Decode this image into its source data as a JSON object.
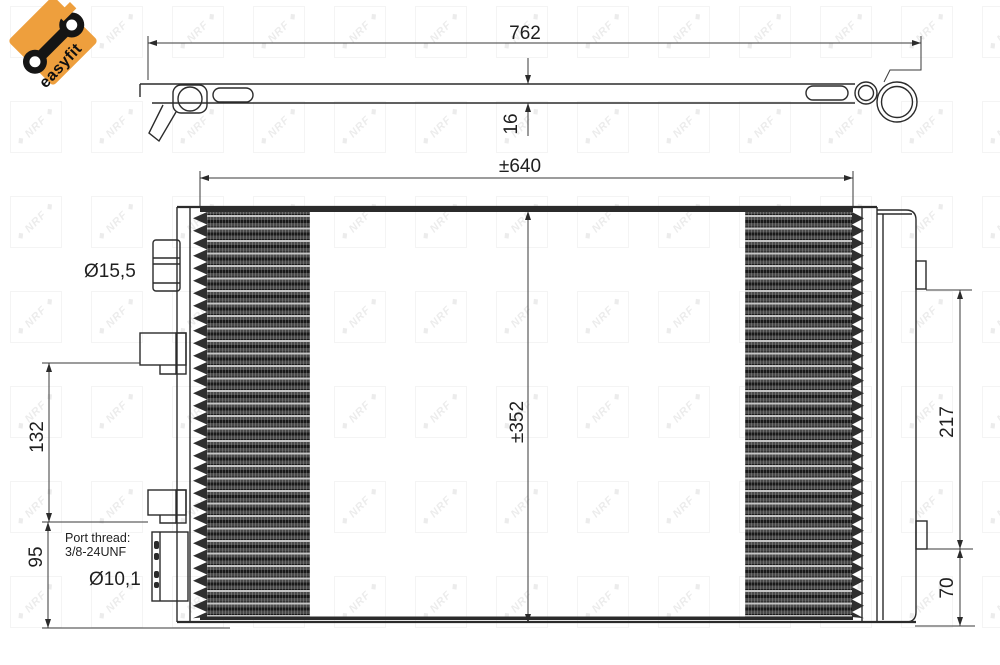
{
  "logo": {
    "brand": "easyfit",
    "bg_color": "#EE9F3D"
  },
  "watermark": {
    "text": "NRF",
    "diamond": "◆"
  },
  "dimensions": {
    "overall_length": "762",
    "thickness": "16",
    "core_width": "±640",
    "core_height": "±352",
    "top_port_diameter": "Ø15,5",
    "bracket_spacing": "132",
    "lower_section_height": "95",
    "tank_upper_height": "217",
    "tank_lower_height": "70",
    "bottom_port_diameter": "Ø10,1",
    "port_thread_line1": "Port thread:",
    "port_thread_line2": "3/8-24UNF"
  }
}
